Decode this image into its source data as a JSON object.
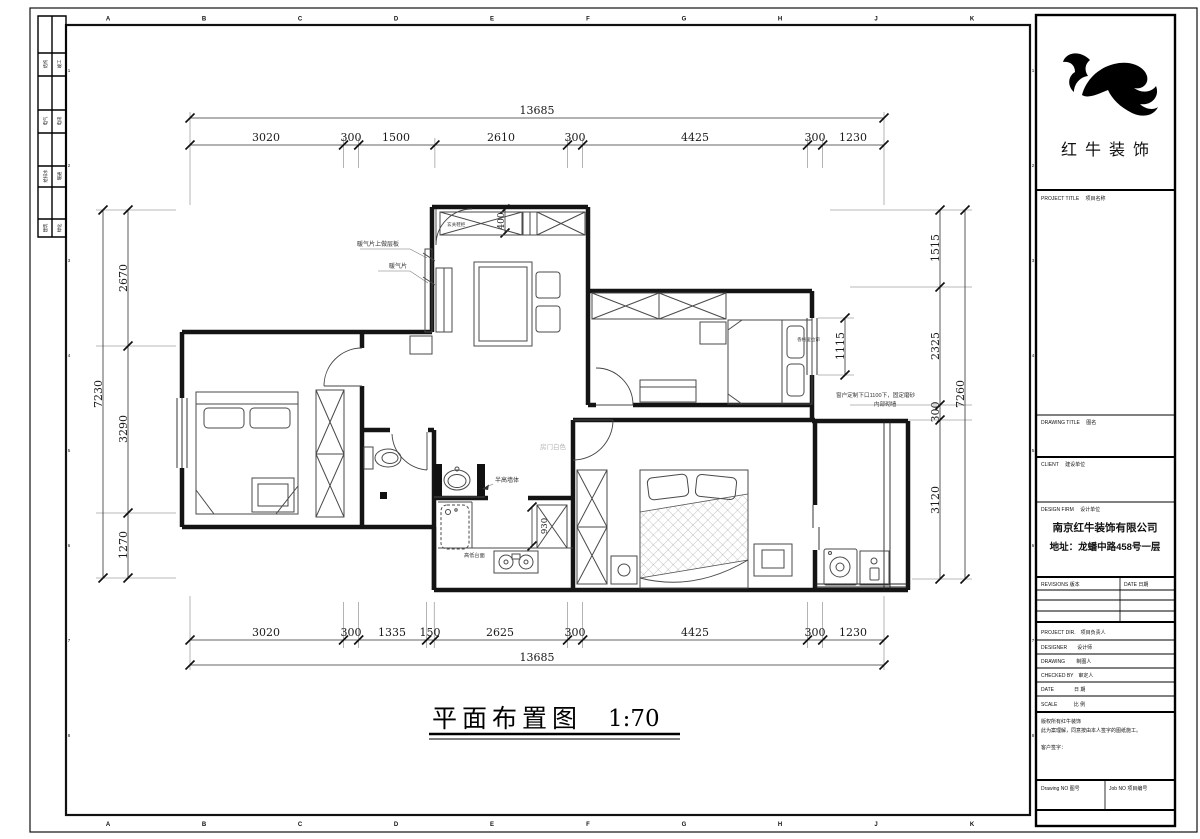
{
  "sheet": {
    "title": "平面布置图",
    "scale_label": "1:70"
  },
  "frame": {
    "letters": [
      "A",
      "B",
      "C",
      "D",
      "E",
      "F",
      "G",
      "H",
      "J",
      "K"
    ],
    "numbers": [
      "1",
      "2",
      "3",
      "4",
      "5",
      "6",
      "7",
      "8"
    ],
    "strip_col1": [
      "结构",
      "电气",
      "给排水",
      "建筑"
    ],
    "strip_col2": [
      "竣工",
      "电讯",
      "暖通",
      "绿化"
    ]
  },
  "plan": {
    "dims": {
      "top_total": "13685",
      "top_segments": [
        "3020",
        "300",
        "1500",
        "2610",
        "300",
        "4425",
        "300",
        "1230"
      ],
      "bottom_segments": [
        "3020",
        "300",
        "1335",
        "150",
        "2625",
        "300",
        "4425",
        "300",
        "1230"
      ],
      "bottom_total": "13685",
      "left_total": "7230",
      "left_segments": [
        "2670",
        "3290",
        "1270"
      ],
      "right_total": "7260",
      "right_segments": [
        "1515",
        "2325",
        "300",
        "3120"
      ],
      "window_width": "1115",
      "cabinet_depth": "400",
      "fridge_width": "930"
    },
    "annotations": {
      "radiator_shelf": "暖气片上做层板",
      "radiator": "暖气片",
      "entry_cabinet": "玄关鞋柜",
      "window_note_line1": "窗户定制下口1100下，固定磨砂",
      "window_note_line2": "内部砌墙",
      "blind": "香格里拉帘",
      "door_color": "房门白色",
      "half_wall": "半高墙体",
      "counter": "高低台面"
    }
  },
  "title_block": {
    "brand": "红牛装饰",
    "project_title_label": "PROJECT TITLE　 项目名称",
    "drawing_title_label": "DRAWING TITLE　 图名",
    "client_label": "CLIENT　 建设单位",
    "design_firm_label": "DESIGN FIRM　 设计单位",
    "company": "南京红牛装饰有限公司",
    "address": "地址：龙蟠中路458号一层",
    "revisions_label": "REVISIONS 版本",
    "date_col_label": "DATE 日期",
    "project_dir_label": "PROJECT DIR.　项目负责人",
    "designer_label": "DESIGNER　　设计师",
    "drawing_label": "DRAWING　　 制图人",
    "checked_label": "CHECKED BY　审定人",
    "date_label": "DATE　　　　日 期",
    "scale_label": "SCALE　　　 比 例",
    "copyright_line1": "版权所有红牛装饰",
    "copyright_line2": "此为案理解，同意按由本人签字的图纸施工。",
    "customer_sign": "客户签字：",
    "drawing_no_label": "Drawing NO 图号",
    "job_no_label": "Job NO 项目编号"
  },
  "colors": {
    "line": "#141414",
    "furniture": "#4a4a4a",
    "gray_text": "#b3b3b3"
  }
}
